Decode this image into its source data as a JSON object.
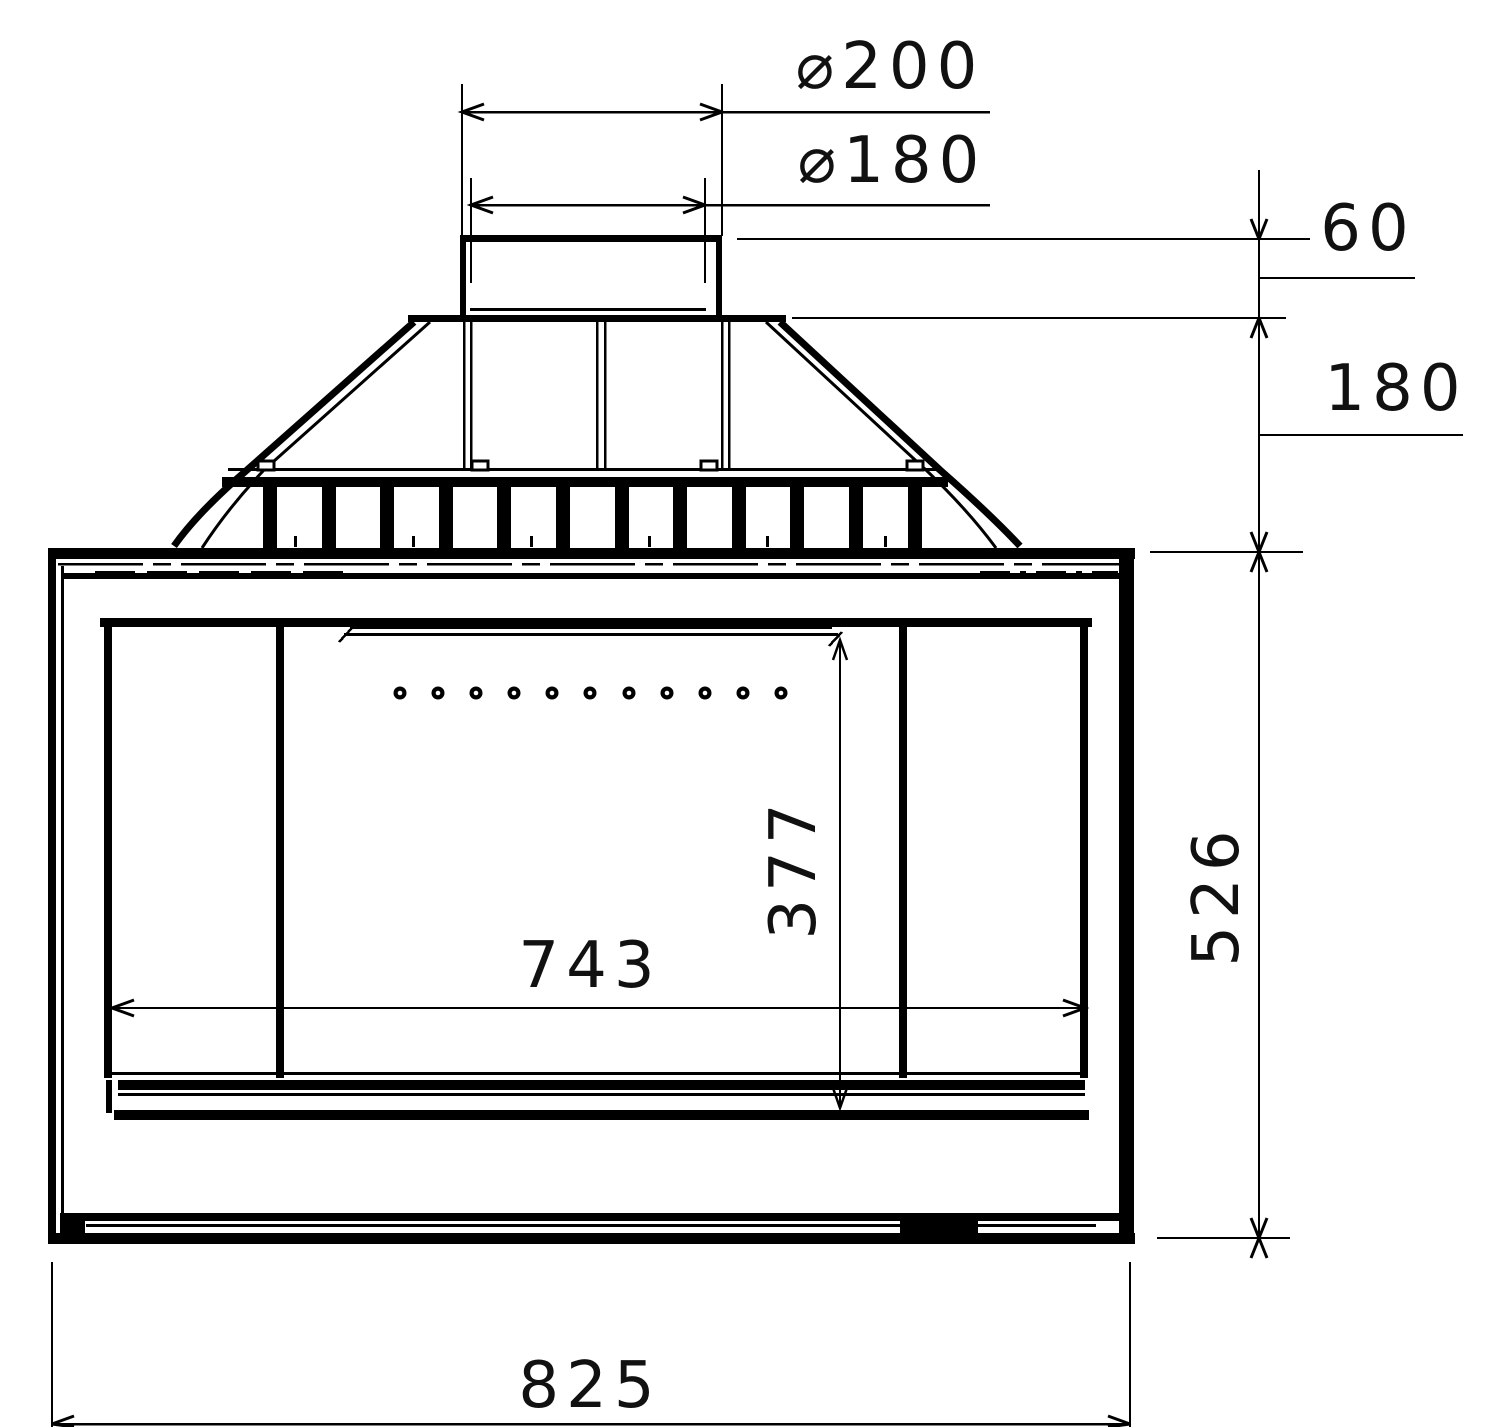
{
  "dimensions": {
    "flue_outer": "⌀200",
    "flue_inner": "⌀180",
    "collar_height": "60",
    "hood_height": "180",
    "body_height": "526",
    "glass_height": "377",
    "glass_width": "743",
    "overall_width": "825"
  }
}
